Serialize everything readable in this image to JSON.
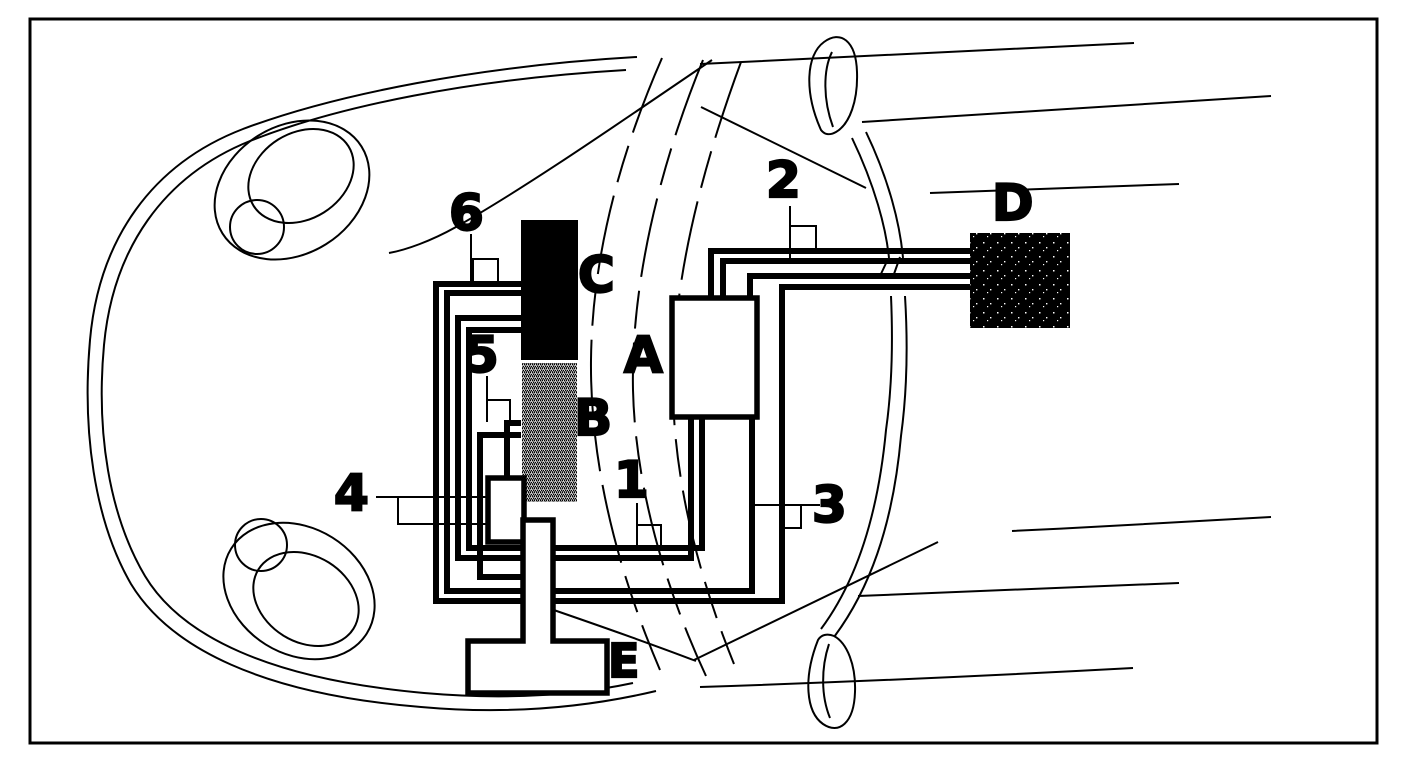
{
  "diagram": {
    "title": "car-top-view-wiring-routing-diagram",
    "component_labels": {
      "a": "A",
      "b": "B",
      "c": "C",
      "d": "D",
      "e": "E"
    },
    "position_markers": {
      "n1": "1",
      "n2": "2",
      "n3": "3",
      "n4": "4",
      "n5": "5",
      "n6": "6"
    },
    "colors": {
      "ink": "#000000",
      "paper": "#ffffff",
      "block_c_fill": "#000000",
      "block_d_fill": "#000000",
      "block_b_fill": "stippled-gray",
      "block_a_fill": "#ffffff",
      "block_e_fill": "#ffffff"
    }
  }
}
